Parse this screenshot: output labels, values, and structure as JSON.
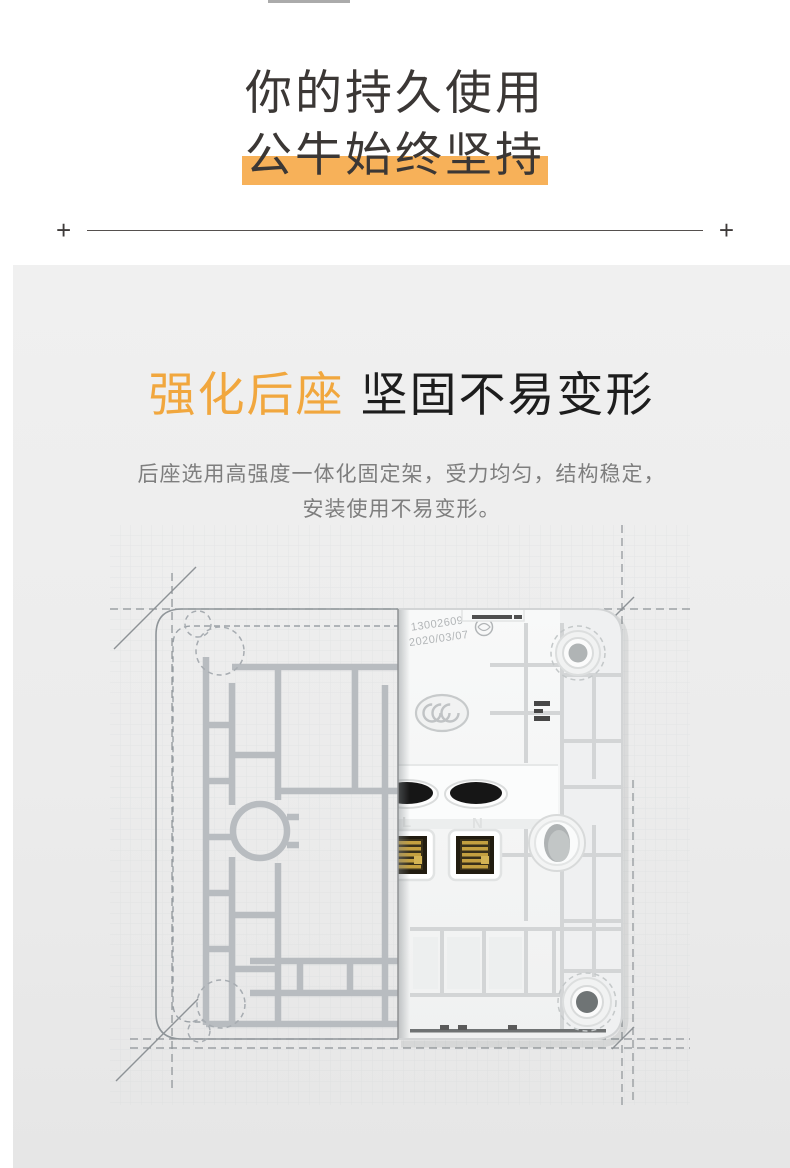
{
  "theme": {
    "accent_orange": "#F1A73E",
    "highlight_amber": "#F7B159",
    "heading_dark": "#3B3735",
    "body_gray": "#7E7E7E",
    "panel_top": "#F0F0F0",
    "panel_bottom": "#E6E6E6",
    "divider_gray": "#55504E"
  },
  "hero": {
    "line1": "你的持久使用",
    "line2": "公牛始终坚持"
  },
  "divider": {
    "left_mark": "+",
    "right_mark": "+"
  },
  "section": {
    "title_accent": "强化后座",
    "title_main": "坚固不易变形",
    "desc_line1": "后座选用高强度一体化固定架，受力均匀，结构稳定，",
    "desc_line2": "安装使用不易变形。"
  },
  "product": {
    "stamp_code": "13002609",
    "stamp_date": "2020/03/07",
    "terminal_live": "L",
    "terminal_neutral": "N",
    "cert_mark": "CCC"
  }
}
